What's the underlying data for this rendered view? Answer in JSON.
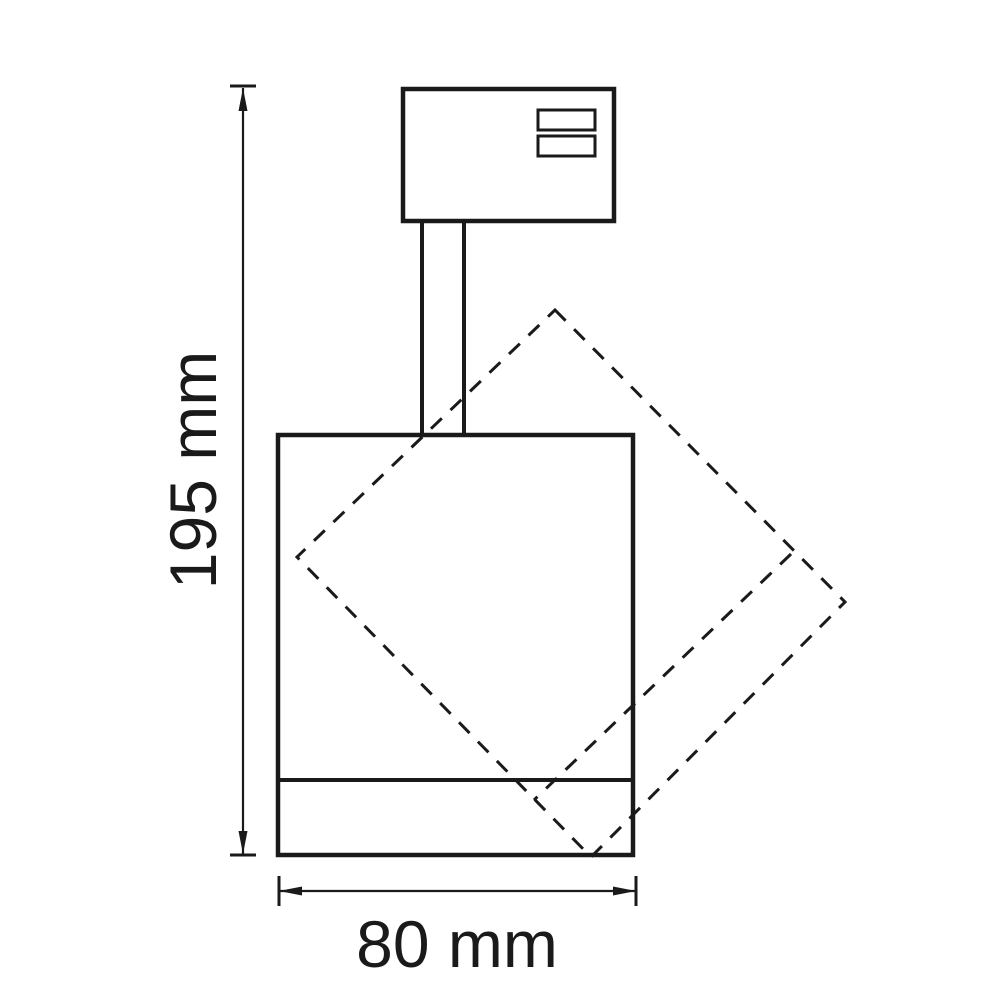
{
  "figure": {
    "kind": "technical dimension drawing",
    "subject": "track spotlight side view with dashed outline of rotated lamp head",
    "background_color": "#ffffff",
    "line_color": "#1a1a1a"
  },
  "dimensions": {
    "height": {
      "label": "195 mm",
      "value": 195,
      "unit": "mm",
      "orientation": "vertical"
    },
    "width": {
      "label": "80 mm",
      "value": 80,
      "unit": "mm",
      "orientation": "horizontal"
    }
  }
}
